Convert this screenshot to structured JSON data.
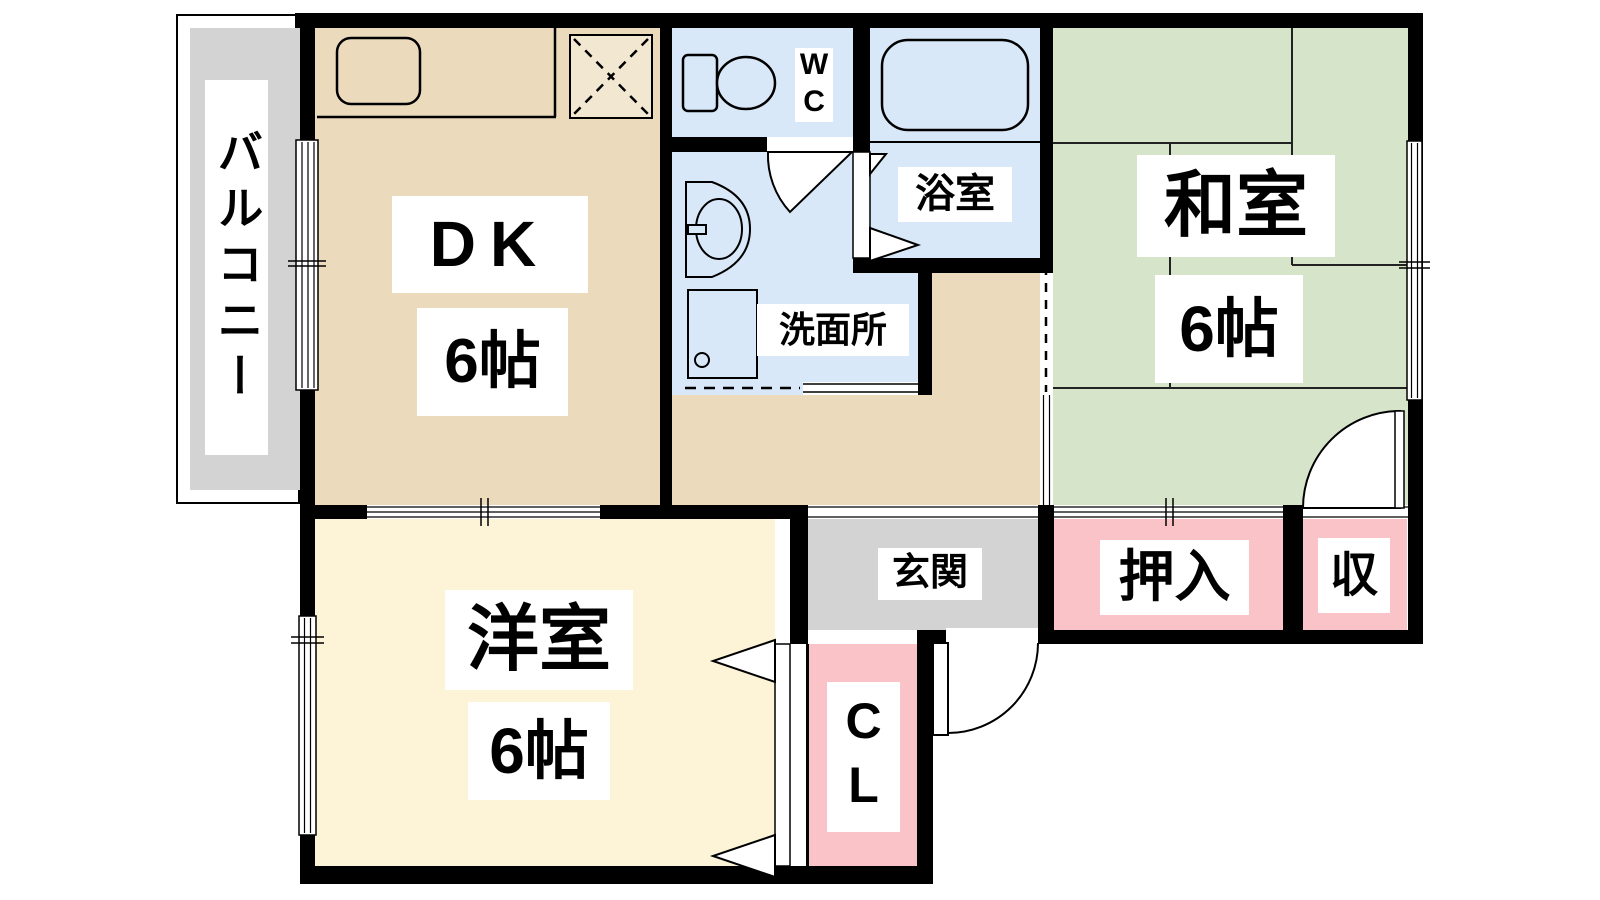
{
  "plan_title": "1DK+2room apartment floor plan",
  "rooms": {
    "balcony": {
      "label": "バルコニー"
    },
    "dk": {
      "label": "DK",
      "size": "6帖"
    },
    "wc": {
      "label": "WC"
    },
    "bath": {
      "label": "浴室"
    },
    "washroom": {
      "label": "洗面所"
    },
    "japanese_room": {
      "label": "和室",
      "size": "6帖"
    },
    "entrance": {
      "label": "玄関"
    },
    "oshiire": {
      "label": "押入"
    },
    "storage": {
      "label": "収"
    },
    "closet": {
      "label": "CL"
    },
    "western_room": {
      "label": "洋室",
      "size": "6帖"
    }
  },
  "colors": {
    "wall": "#000000",
    "dk_hall_floor": "#ecdabd",
    "western_room_floor": "#fdf3d6",
    "tatami_floor": "#d6e5c9",
    "wet_area_floor": "#d9e8f8",
    "closet_pink": "#fac3c7",
    "entrance_gray": "#d3d3d3",
    "label_bg": "#ffffff"
  }
}
